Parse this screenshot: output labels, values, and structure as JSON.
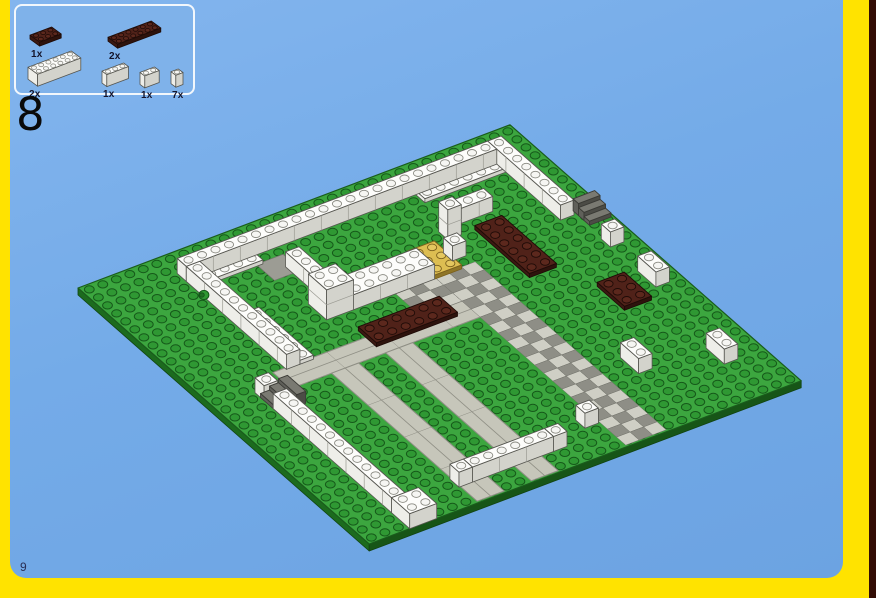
{
  "page": {
    "step_number": "8",
    "page_number": "9",
    "colors": {
      "background_blue": "#74ABE8",
      "frame_yellow": "#FFE300",
      "right_edge_dark": "#330D05",
      "callout_fill": "#7FB2EA",
      "callout_border": "#F2F7FC",
      "green_plate_top": "#3CA63F",
      "green_plate_side": "#1C6B1E",
      "green_plate_side2": "#175517",
      "green_stud": "#2F9833",
      "green_stud_stroke": "#16591A",
      "plate_outline": "#1A5C1C",
      "white_top": "#FDFDFB",
      "white_left": "#EEEEE9",
      "white_right": "#D3D3CC",
      "white_stud": "#F6F6F3",
      "white_stroke": "#55554F",
      "brown_top": "#502219",
      "brown_left": "#3C1912",
      "brown_right": "#2E130D",
      "brown_stud": "#5C281D",
      "brown_stroke": "#1E0B07",
      "tan_top": "#DDBE52",
      "tan_left": "#B59638",
      "tan_right": "#8F7526",
      "tan_stud": "#E4C75F",
      "tan_stroke": "#7A5F1C",
      "road_fill": "#C6C6BA",
      "road_stroke": "#8F8F85",
      "checker_light": "#CFCFC5",
      "checker_dark": "#8E8E86",
      "checker_stroke": "#73736C",
      "stair_top": "#7A7A72",
      "stair_left": "#60605A",
      "stair_right": "#4C4C46",
      "tile_gray": "#9C9C94",
      "round_green": "#2F9833"
    }
  },
  "parts_callout": {
    "items": [
      {
        "name": "brown-plate-2x3",
        "count_label": "1x",
        "color": "brown",
        "kind": "plate",
        "w": 3,
        "d": 2
      },
      {
        "name": "brown-plate-2x6",
        "count_label": "2x",
        "color": "brown",
        "kind": "plate",
        "w": 6,
        "d": 2
      },
      {
        "name": "white-brick-2x6",
        "count_label": "2x",
        "color": "white",
        "kind": "brick",
        "w": 6,
        "d": 2
      },
      {
        "name": "white-brick-1x3",
        "count_label": "1x",
        "color": "white",
        "kind": "brick",
        "w": 3,
        "d": 1
      },
      {
        "name": "white-brick-1x2",
        "count_label": "1x",
        "color": "white",
        "kind": "brick",
        "w": 2,
        "d": 1
      },
      {
        "name": "white-brick-1x1",
        "count_label": "7x",
        "color": "white",
        "kind": "brick",
        "w": 1,
        "d": 1
      }
    ]
  },
  "scene": {
    "baseplate": {
      "size": 32,
      "color": "green"
    },
    "flats": [
      {
        "type": "tile_patch",
        "name": "gray-tile-2x2",
        "u": 10.5,
        "v": 4,
        "du": 2,
        "dv": 2
      },
      {
        "type": "road",
        "name": "road-upper",
        "axis": "u",
        "u": 5,
        "v": 14,
        "du": 15,
        "dv": 2
      },
      {
        "type": "road",
        "name": "road-lower-left",
        "axis": "v",
        "u": 8,
        "v": 16,
        "du": 2,
        "dv": 16
      },
      {
        "type": "road",
        "name": "road-lower-right",
        "axis": "v",
        "u": 12,
        "v": 16,
        "du": 2,
        "dv": 16
      },
      {
        "type": "checker",
        "name": "checker-apron",
        "u": 16,
        "v": 11,
        "du": 4,
        "dv": 3
      },
      {
        "type": "checker",
        "name": "checker-path",
        "u": 19,
        "v": 11,
        "du": 3,
        "dv": 21
      },
      {
        "type": "plate",
        "color": "white",
        "name": "white-plate-back-left",
        "u": 6,
        "v": 3,
        "du": 5,
        "dv": 1
      },
      {
        "type": "plate",
        "color": "white",
        "name": "white-plate-back-right",
        "u": 23,
        "v": 3,
        "du": 6,
        "dv": 1
      },
      {
        "type": "plate",
        "color": "white",
        "name": "white-plate-left",
        "u": 7,
        "v": 8,
        "du": 1,
        "dv": 6
      },
      {
        "type": "plate",
        "color": "brown",
        "name": "brown-plate-center",
        "u": 12,
        "v": 13,
        "du": 6,
        "dv": 2
      },
      {
        "type": "plate",
        "color": "brown",
        "name": "brown-plate-right",
        "u": 24,
        "v": 8,
        "du": 2,
        "dv": 6
      },
      {
        "type": "plate",
        "color": "brown",
        "name": "brown-plate-corner",
        "u": 27,
        "v": 17,
        "du": 2,
        "dv": 3
      },
      {
        "type": "plate",
        "color": "tan",
        "name": "tan-plate-entrance",
        "u": 19,
        "v": 8,
        "du": 2,
        "dv": 3
      }
    ],
    "solids": [
      {
        "type": "wall",
        "name": "wall-back",
        "u": 6,
        "v": 2,
        "du": 23,
        "dv": 1,
        "h": 1
      },
      {
        "type": "wall",
        "name": "wall-right",
        "u": 29,
        "v": 2,
        "du": 1,
        "dv": 8,
        "h": 1
      },
      {
        "type": "wall",
        "name": "wall-left",
        "u": 6,
        "v": 3,
        "du": 1,
        "dv": 11,
        "h": 1
      },
      {
        "type": "wall",
        "name": "plaza-wall-vertical",
        "u": 12,
        "v": 5,
        "du": 1,
        "dv": 4,
        "h": 1
      },
      {
        "type": "wall",
        "name": "plaza-corner-tower",
        "u": 11,
        "v": 9,
        "du": 2,
        "dv": 2,
        "h": 2
      },
      {
        "type": "wall",
        "name": "plaza-wall-long",
        "u": 13,
        "v": 9,
        "du": 6,
        "dv": 2,
        "h": 1
      },
      {
        "type": "wall",
        "name": "gate-brick",
        "u": 21,
        "v": 9,
        "du": 1,
        "dv": 1,
        "h": 1
      },
      {
        "type": "wall",
        "name": "white-column",
        "u": 22,
        "v": 7,
        "du": 1,
        "dv": 1,
        "h": 2
      },
      {
        "type": "wall",
        "name": "plaza-wall-right",
        "u": 23,
        "v": 6,
        "du": 3,
        "dv": 1,
        "h": 1
      },
      {
        "type": "wall",
        "name": "edge-wall-lower-left",
        "u": 3,
        "v": 17,
        "du": 1,
        "dv": 13,
        "h": 1
      },
      {
        "type": "wall",
        "name": "white-1x1-a",
        "u": 3,
        "v": 15,
        "du": 1,
        "dv": 1,
        "h": 1
      },
      {
        "type": "wall",
        "name": "white-2x2-corner",
        "u": 3,
        "v": 30,
        "du": 2,
        "dv": 2,
        "h": 1
      },
      {
        "type": "wall",
        "name": "white-1x1-b",
        "u": 8,
        "v": 29,
        "du": 1,
        "dv": 1,
        "h": 1
      },
      {
        "type": "wall",
        "name": "white-1x6-bottom",
        "u": 9,
        "v": 29,
        "du": 6,
        "dv": 1,
        "h": 1
      },
      {
        "type": "wall",
        "name": "white-1x1-c",
        "u": 15,
        "v": 29,
        "du": 1,
        "dv": 1,
        "h": 1
      },
      {
        "type": "wall",
        "name": "white-1x1-d",
        "u": 18,
        "v": 28,
        "du": 1,
        "dv": 1,
        "h": 1
      },
      {
        "type": "wall",
        "name": "white-1x2-corner-right",
        "u": 29,
        "v": 26,
        "du": 1,
        "dv": 2,
        "h": 1
      },
      {
        "type": "wall",
        "name": "white-1x2-right",
        "u": 30,
        "v": 17,
        "du": 1,
        "dv": 2,
        "h": 1
      },
      {
        "type": "wall",
        "name": "white-1x1-e",
        "u": 30,
        "v": 13,
        "du": 1,
        "dv": 1,
        "h": 1
      },
      {
        "type": "wall",
        "name": "white-1x2-mid",
        "u": 24,
        "v": 24,
        "du": 1,
        "dv": 2,
        "h": 1
      },
      {
        "type": "stairs",
        "name": "stairs-left",
        "dir": "u",
        "u": 3,
        "v": 15.6,
        "du": 2,
        "dv": 2
      },
      {
        "type": "stairs",
        "name": "stairs-right",
        "dir": "v",
        "u": 30.2,
        "v": 9.6,
        "du": 1.6,
        "dv": 1.8
      },
      {
        "type": "round1",
        "name": "green-round-brick",
        "u": 6,
        "v": 5.2
      }
    ]
  }
}
